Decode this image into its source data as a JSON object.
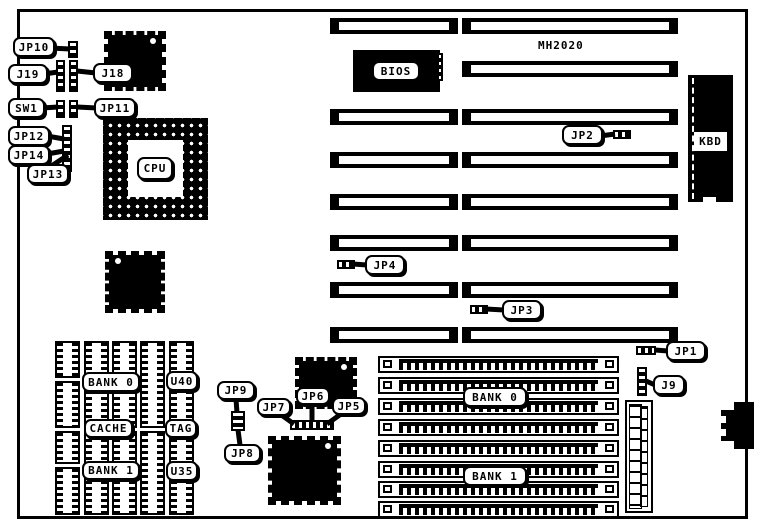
{
  "board": {
    "model": "MH2020",
    "callouts": {
      "jp10": "JP10",
      "j19": "J19",
      "j18": "J18",
      "sw1": "SW1",
      "jp11": "JP11",
      "jp12": "JP12",
      "jp14": "JP14",
      "jp13": "JP13",
      "jp2": "JP2",
      "jp4": "JP4",
      "jp3": "JP3",
      "jp1": "JP1",
      "j9": "J9",
      "jp9": "JP9",
      "jp8": "JP8",
      "jp7": "JP7",
      "jp6": "JP6",
      "jp5": "JP5"
    },
    "chips": {
      "cpu": "CPU",
      "bios": "BIOS",
      "kbd": "KBD"
    },
    "memory": {
      "cache_bank0": "BANK 0",
      "cache": "CACHE",
      "cache_bank1": "BANK 1",
      "u40": "U40",
      "tag": "TAG",
      "u35": "U35",
      "simm_bank0": "BANK 0",
      "simm_bank1": "BANK 1"
    }
  }
}
